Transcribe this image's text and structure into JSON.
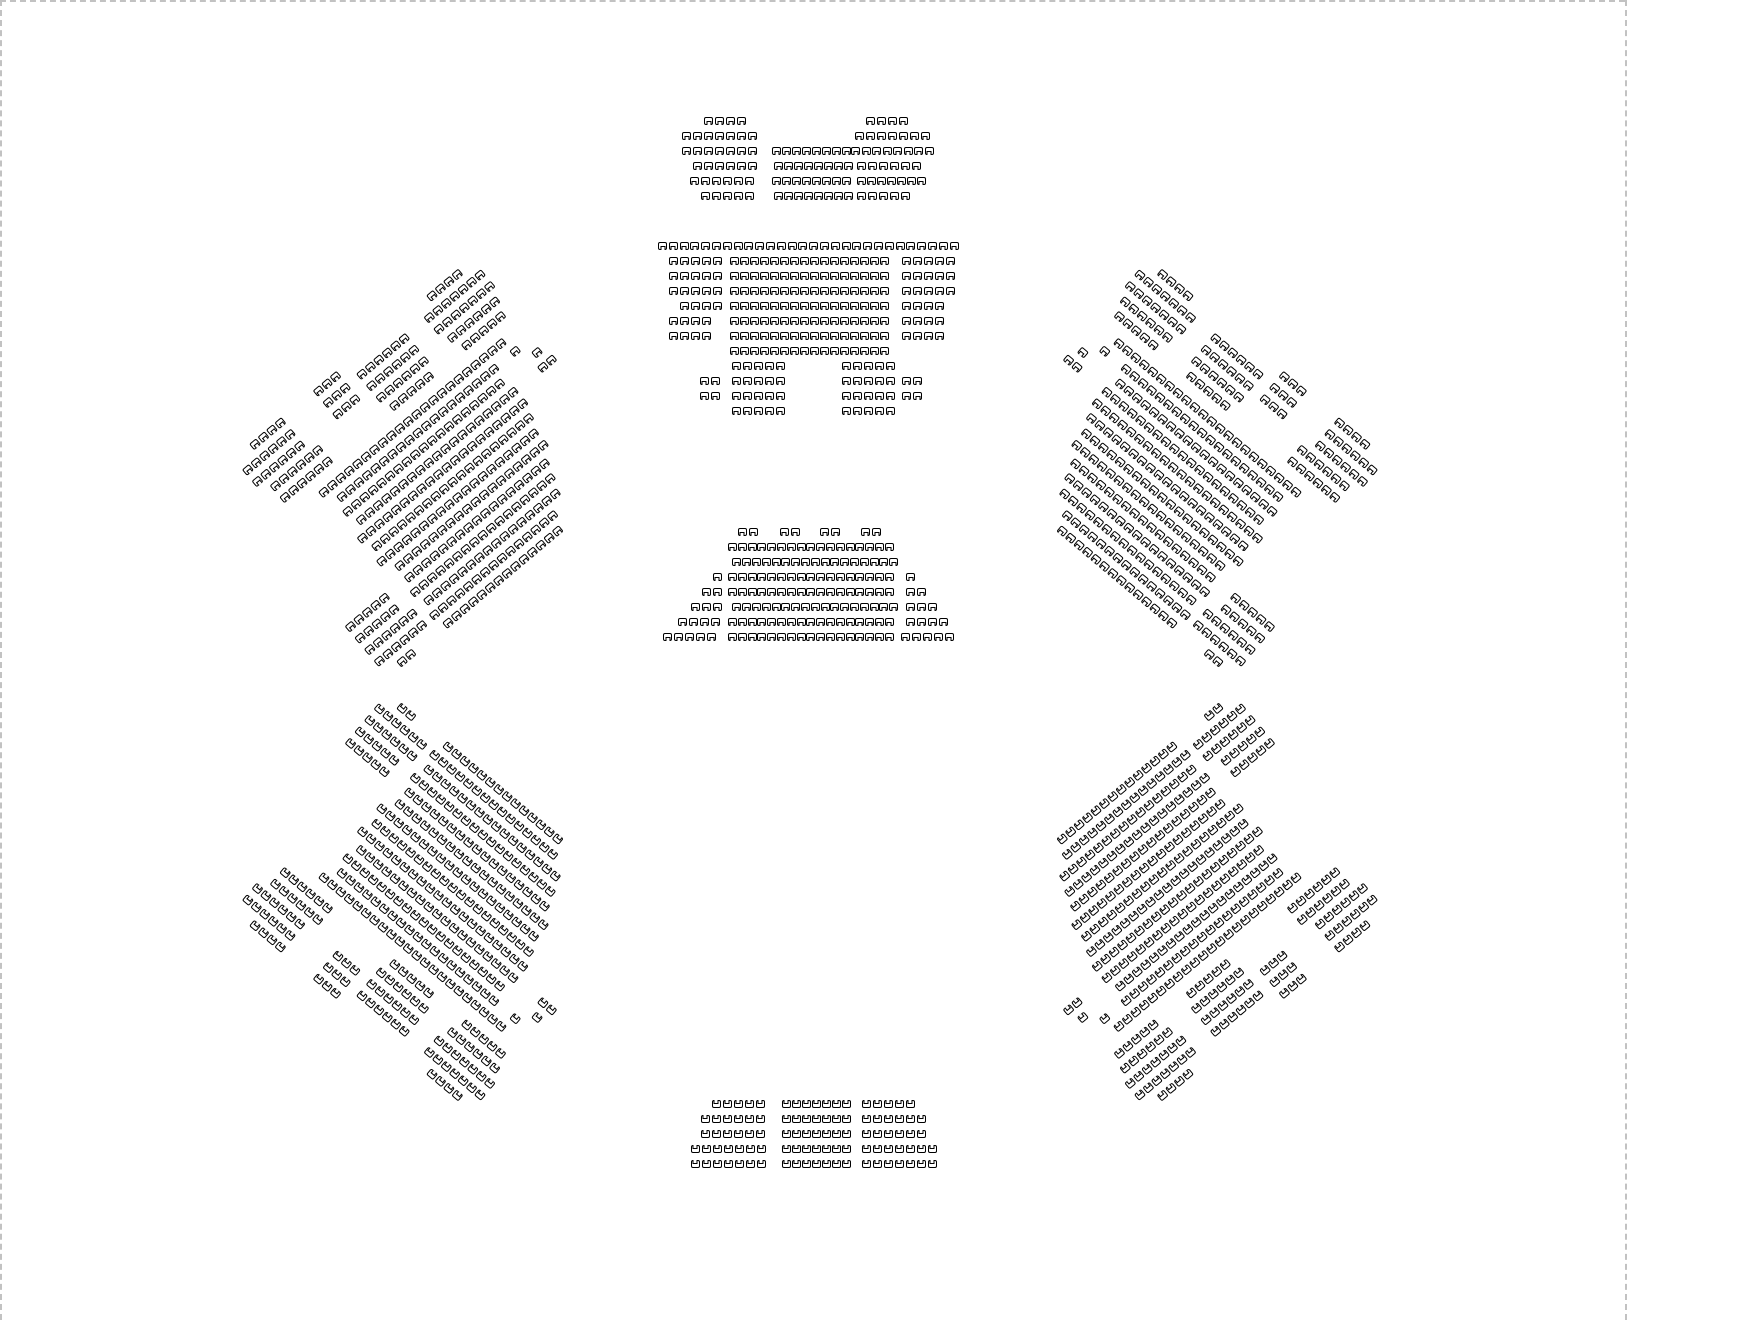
{
  "canvas": {
    "width": 1760,
    "height": 1320,
    "background": "#ffffff",
    "artboard_edge_color": "#c2c2c2",
    "edges": [
      {
        "id": "artboard-top-edge",
        "type": "h",
        "x": 0,
        "y": 0,
        "length": 1625
      },
      {
        "id": "artboard-left-edge",
        "type": "v",
        "x": 0,
        "y": 0,
        "length": 1320
      },
      {
        "id": "artboard-right-edge",
        "type": "v",
        "x": 1625,
        "y": 0,
        "length": 1320
      }
    ]
  },
  "seat_style": {
    "outline": "#000000",
    "fill": "#ffffff",
    "width": 9,
    "height": 8,
    "corner_radius": 2,
    "notch_width": 5,
    "notch_height": 4
  },
  "metrics": {
    "seat_pitch": 11,
    "row_pitch": 15
  },
  "shared_layouts": {
    "wing": {
      "rows": [
        {
          "y": -5.4,
          "segs": [
            [
              -2,
              4
            ],
            [
              5.5,
              3
            ],
            [
              19,
              4
            ]
          ]
        },
        {
          "y": -4.4,
          "segs": [
            [
              -4,
              6
            ],
            [
              5.5,
              3
            ],
            [
              9.5,
              6
            ],
            [
              17.5,
              7
            ]
          ]
        },
        {
          "y": -3.4,
          "segs": [
            [
              -4,
              6
            ],
            [
              5.5,
              3
            ],
            [
              9.5,
              6
            ],
            [
              17.5,
              7
            ]
          ]
        },
        {
          "y": -2.4,
          "segs": [
            [
              -3,
              6
            ],
            [
              9.5,
              6
            ],
            [
              18,
              6
            ]
          ]
        },
        {
          "y": -1.4,
          "segs": [
            [
              -3,
              6
            ],
            [
              10,
              5
            ],
            [
              18.5,
              5
            ]
          ]
        },
        {
          "y": 0,
          "segs": [
            [
              0,
              22
            ]
          ]
        },
        {
          "y": 1,
          "segs": [
            [
              1,
              19
            ],
            [
              21.5,
              1
            ]
          ]
        },
        {
          "y": 2,
          "segs": [
            [
              0.5,
              19
            ],
            [
              23,
              1
            ]
          ]
        },
        {
          "y": 3,
          "segs": [
            [
              1,
              19
            ],
            [
              22.5,
              2
            ]
          ]
        },
        {
          "y": 4,
          "segs": [
            [
              0,
              20
            ]
          ]
        },
        {
          "y": 5,
          "segs": [
            [
              0.5,
              19
            ]
          ]
        },
        {
          "y": 6,
          "segs": [
            [
              0,
              19
            ]
          ]
        },
        {
          "y": 7,
          "segs": [
            [
              1,
              18
            ]
          ]
        },
        {
          "y": 8,
          "segs": [
            [
              -6,
              5
            ],
            [
              1,
              17
            ]
          ]
        },
        {
          "y": 9,
          "segs": [
            [
              -6,
              5
            ],
            [
              0.5,
              17
            ]
          ]
        },
        {
          "y": 10,
          "segs": [
            [
              -6,
              6
            ],
            [
              1,
              16
            ]
          ]
        },
        {
          "y": 11,
          "segs": [
            [
              -6,
              6
            ],
            [
              0.5,
              15
            ]
          ]
        },
        {
          "y": 12,
          "segs": [
            [
              -4.5,
              2
            ],
            [
              1,
              14
            ]
          ]
        }
      ]
    }
  },
  "sections": [
    {
      "id": "top-center",
      "x": 682,
      "y": 117,
      "rot": 0,
      "mirror_x": false,
      "mirror_y": false,
      "dir": "down",
      "rows": [
        {
          "y": 0,
          "segs": [
            [
              2,
              4
            ],
            [
              16.7,
              4
            ]
          ]
        },
        {
          "y": 1,
          "segs": [
            [
              0,
              7
            ],
            [
              15.7,
              7
            ]
          ]
        },
        {
          "y": 2,
          "segs": [
            [
              0,
              7
            ],
            [
              8.2,
              8,
              10
            ],
            [
              15.4,
              8,
              10.5
            ]
          ]
        },
        {
          "y": 3,
          "segs": [
            [
              1,
              6
            ],
            [
              8.4,
              8,
              10
            ],
            [
              15.9,
              6
            ]
          ]
        },
        {
          "y": 4,
          "segs": [
            [
              0.7,
              6
            ],
            [
              8.2,
              8,
              10
            ],
            [
              15.9,
              7,
              10
            ]
          ]
        },
        {
          "y": 5,
          "segs": [
            [
              1.7,
              5
            ],
            [
              8.4,
              8,
              10
            ],
            [
              15.9,
              5
            ]
          ]
        }
      ]
    },
    {
      "id": "center-main",
      "x": 658,
      "y": 242,
      "rot": 0,
      "mirror_x": false,
      "mirror_y": false,
      "dir": "down",
      "rows": [
        {
          "y": 0,
          "segs": [
            [
              0,
              28,
              10.8
            ]
          ]
        },
        {
          "y": 1,
          "segs": [
            [
              1,
              5
            ],
            [
              6.5,
              16,
              10
            ],
            [
              22.2,
              5
            ]
          ]
        },
        {
          "y": 2,
          "segs": [
            [
              1,
              5
            ],
            [
              6.5,
              16,
              10
            ],
            [
              22.2,
              5
            ]
          ]
        },
        {
          "y": 3,
          "segs": [
            [
              1,
              5
            ],
            [
              6.5,
              16,
              10
            ],
            [
              22.2,
              5
            ]
          ]
        },
        {
          "y": 4,
          "segs": [
            [
              2,
              4
            ],
            [
              6.5,
              16,
              10
            ],
            [
              22.2,
              4
            ]
          ]
        },
        {
          "y": 5,
          "segs": [
            [
              1,
              4
            ],
            [
              6.5,
              16,
              10
            ],
            [
              22.2,
              4
            ]
          ]
        },
        {
          "y": 6,
          "segs": [
            [
              1,
              4
            ],
            [
              6.5,
              16,
              10
            ],
            [
              22.2,
              4
            ]
          ]
        },
        {
          "y": 7,
          "segs": [
            [
              6.5,
              16,
              10
            ]
          ]
        },
        {
          "y": 8,
          "segs": [
            [
              6.7,
              5
            ],
            [
              16.7,
              5
            ]
          ]
        },
        {
          "y": 9,
          "segs": [
            [
              3.8,
              2
            ],
            [
              6.7,
              5
            ],
            [
              16.7,
              5
            ],
            [
              22.2,
              2
            ]
          ]
        },
        {
          "y": 10,
          "segs": [
            [
              3.8,
              2
            ],
            [
              6.7,
              5
            ],
            [
              16.7,
              5
            ],
            [
              22.2,
              2
            ]
          ]
        },
        {
          "y": 11,
          "segs": [
            [
              6.7,
              5
            ],
            [
              16.7,
              5
            ]
          ]
        }
      ]
    },
    {
      "id": "mid-center",
      "x": 663,
      "y": 528,
      "rot": 0,
      "mirror_x": false,
      "mirror_y": false,
      "dir": "down",
      "rows": [
        {
          "y": 0,
          "segs": [
            [
              6.8,
              2
            ],
            [
              10.6,
              2
            ],
            [
              14.3,
              2
            ],
            [
              18,
              2
            ]
          ]
        },
        {
          "y": 1,
          "segs": [
            [
              5.9,
              17,
              9.8
            ]
          ]
        },
        {
          "y": 2,
          "segs": [
            [
              6.3,
              17,
              9.8
            ]
          ]
        },
        {
          "y": 3,
          "segs": [
            [
              4.5,
              1
            ],
            [
              5.9,
              17,
              9.8
            ],
            [
              22.1,
              1
            ]
          ]
        },
        {
          "y": 4,
          "segs": [
            [
              3.5,
              2
            ],
            [
              5.9,
              17,
              9.8
            ],
            [
              22.1,
              2
            ]
          ]
        },
        {
          "y": 5,
          "segs": [
            [
              2.5,
              3
            ],
            [
              6.3,
              17,
              9.8
            ],
            [
              22.1,
              3
            ]
          ]
        },
        {
          "y": 6,
          "segs": [
            [
              1.4,
              4
            ],
            [
              5.9,
              17,
              9.8
            ],
            [
              22.1,
              4
            ]
          ]
        },
        {
          "y": 7,
          "segs": [
            [
              0,
              5
            ],
            [
              5.9,
              17,
              9.8
            ],
            [
              21.6,
              5
            ]
          ]
        }
      ]
    },
    {
      "id": "bottom-center",
      "x": 691,
      "y": 1100,
      "rot": 0,
      "mirror_x": false,
      "mirror_y": false,
      "dir": "up",
      "rows": [
        {
          "y": 0,
          "segs": [
            [
              1.9,
              5
            ],
            [
              8.3,
              7,
              10
            ],
            [
              15.5,
              5
            ]
          ]
        },
        {
          "y": 1,
          "segs": [
            [
              0.9,
              6
            ],
            [
              8.3,
              7,
              10
            ],
            [
              15.5,
              6
            ]
          ]
        },
        {
          "y": 2,
          "segs": [
            [
              0.9,
              6
            ],
            [
              8.3,
              7,
              10
            ],
            [
              15.5,
              6
            ]
          ]
        },
        {
          "y": 3,
          "segs": [
            [
              0,
              7
            ],
            [
              8.3,
              7,
              10
            ],
            [
              15.5,
              7
            ]
          ]
        },
        {
          "y": 4,
          "segs": [
            [
              0,
              7
            ],
            [
              8.3,
              7,
              10
            ],
            [
              15.5,
              7
            ]
          ]
        }
      ]
    },
    {
      "id": "wing-upper-left",
      "x": 318,
      "y": 492,
      "rot": -40,
      "mirror_x": false,
      "mirror_y": false,
      "dir": "down",
      "layout": "wing"
    },
    {
      "id": "wing-upper-right",
      "x": 1302,
      "y": 492,
      "rot": 40,
      "mirror_x": true,
      "mirror_y": false,
      "dir": "down",
      "layout": "wing"
    },
    {
      "id": "wing-lower-left",
      "x": 318,
      "y": 878,
      "rot": 40,
      "mirror_x": false,
      "mirror_y": true,
      "dir": "up",
      "layout": "wing"
    },
    {
      "id": "wing-lower-right",
      "x": 1302,
      "y": 878,
      "rot": -40,
      "mirror_x": true,
      "mirror_y": true,
      "dir": "up",
      "layout": "wing"
    }
  ]
}
